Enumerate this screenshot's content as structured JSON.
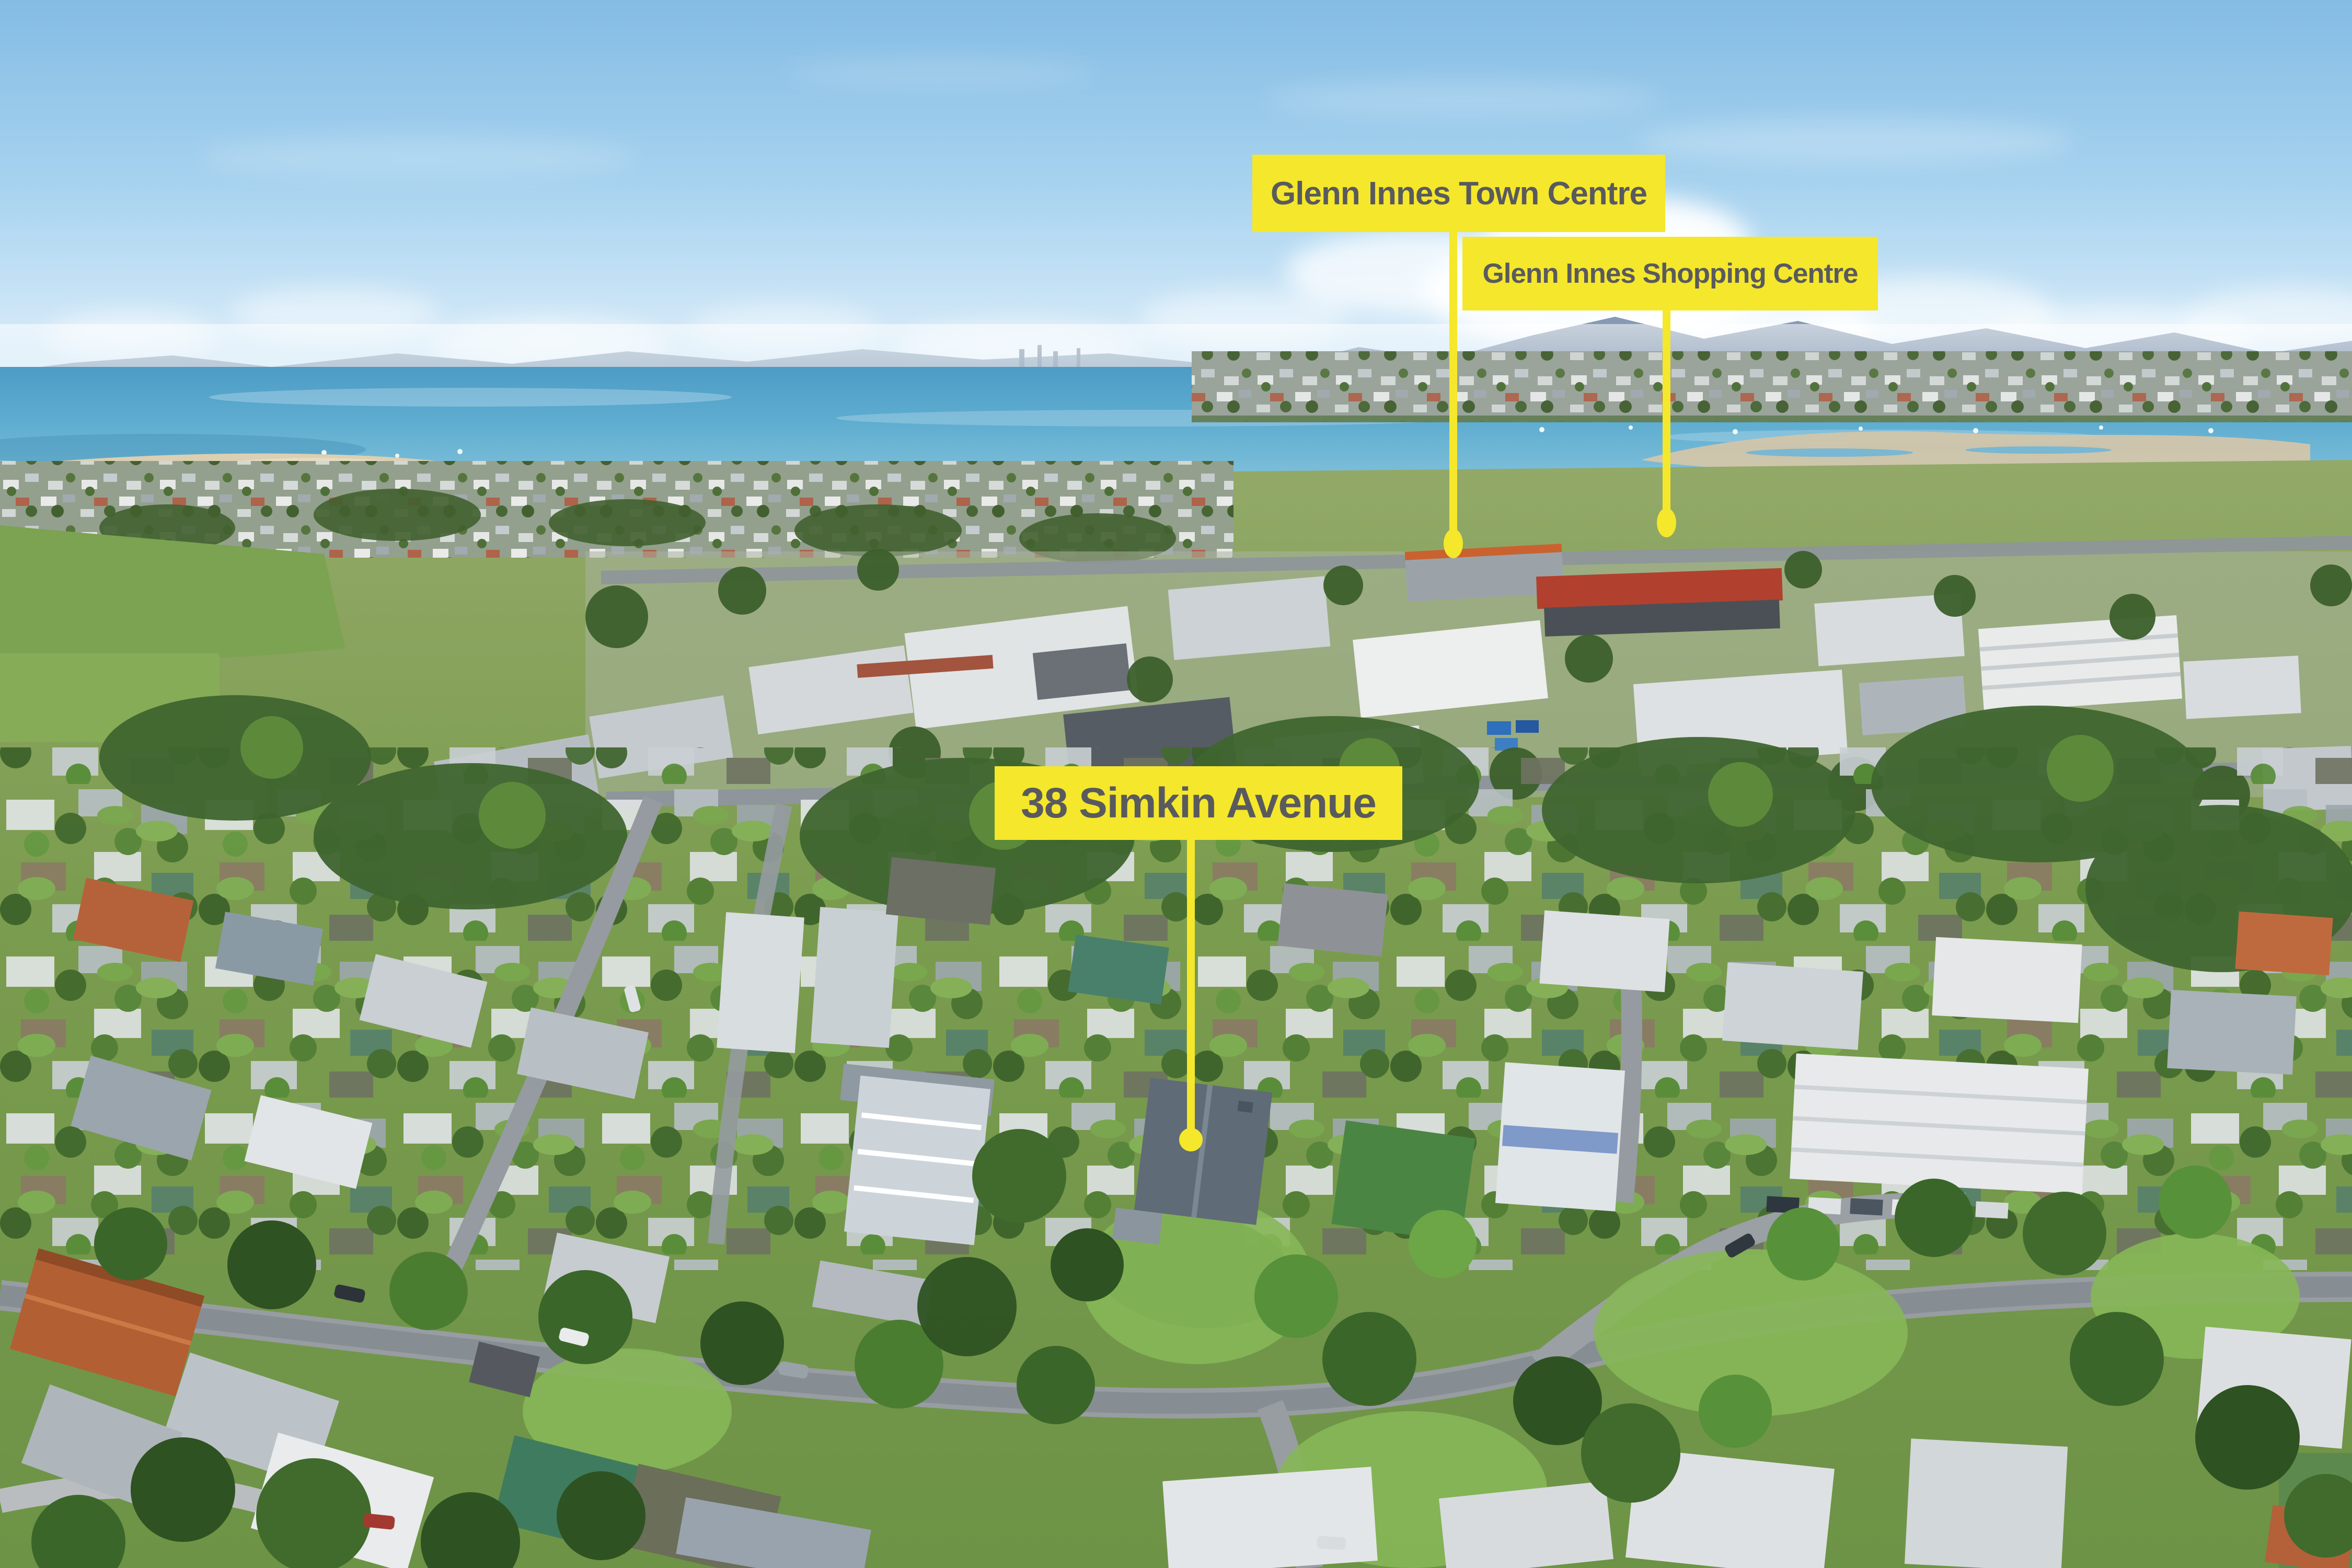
{
  "annotations": {
    "town_centre": {
      "label": "Glenn Innes Town Centre"
    },
    "shopping_centre": {
      "label": "Glenn Innes Shopping Centre"
    },
    "property": {
      "label": "38 Simkin Avenue"
    }
  },
  "colors": {
    "annotation_bg": "#F5E72B",
    "annotation_text": "#595A5E",
    "sky": "#8FC3E6",
    "water": "#55A7C9",
    "hills": "#7E95AF",
    "sand": "#D3C6AA",
    "vegetation": "#6E9347",
    "road": "#979DA1",
    "roof_grey": "#C2C9CE",
    "roof_rust": "#B25F33",
    "roof_teal": "#3F7B5E",
    "subject_roof": "#5F6B76"
  }
}
